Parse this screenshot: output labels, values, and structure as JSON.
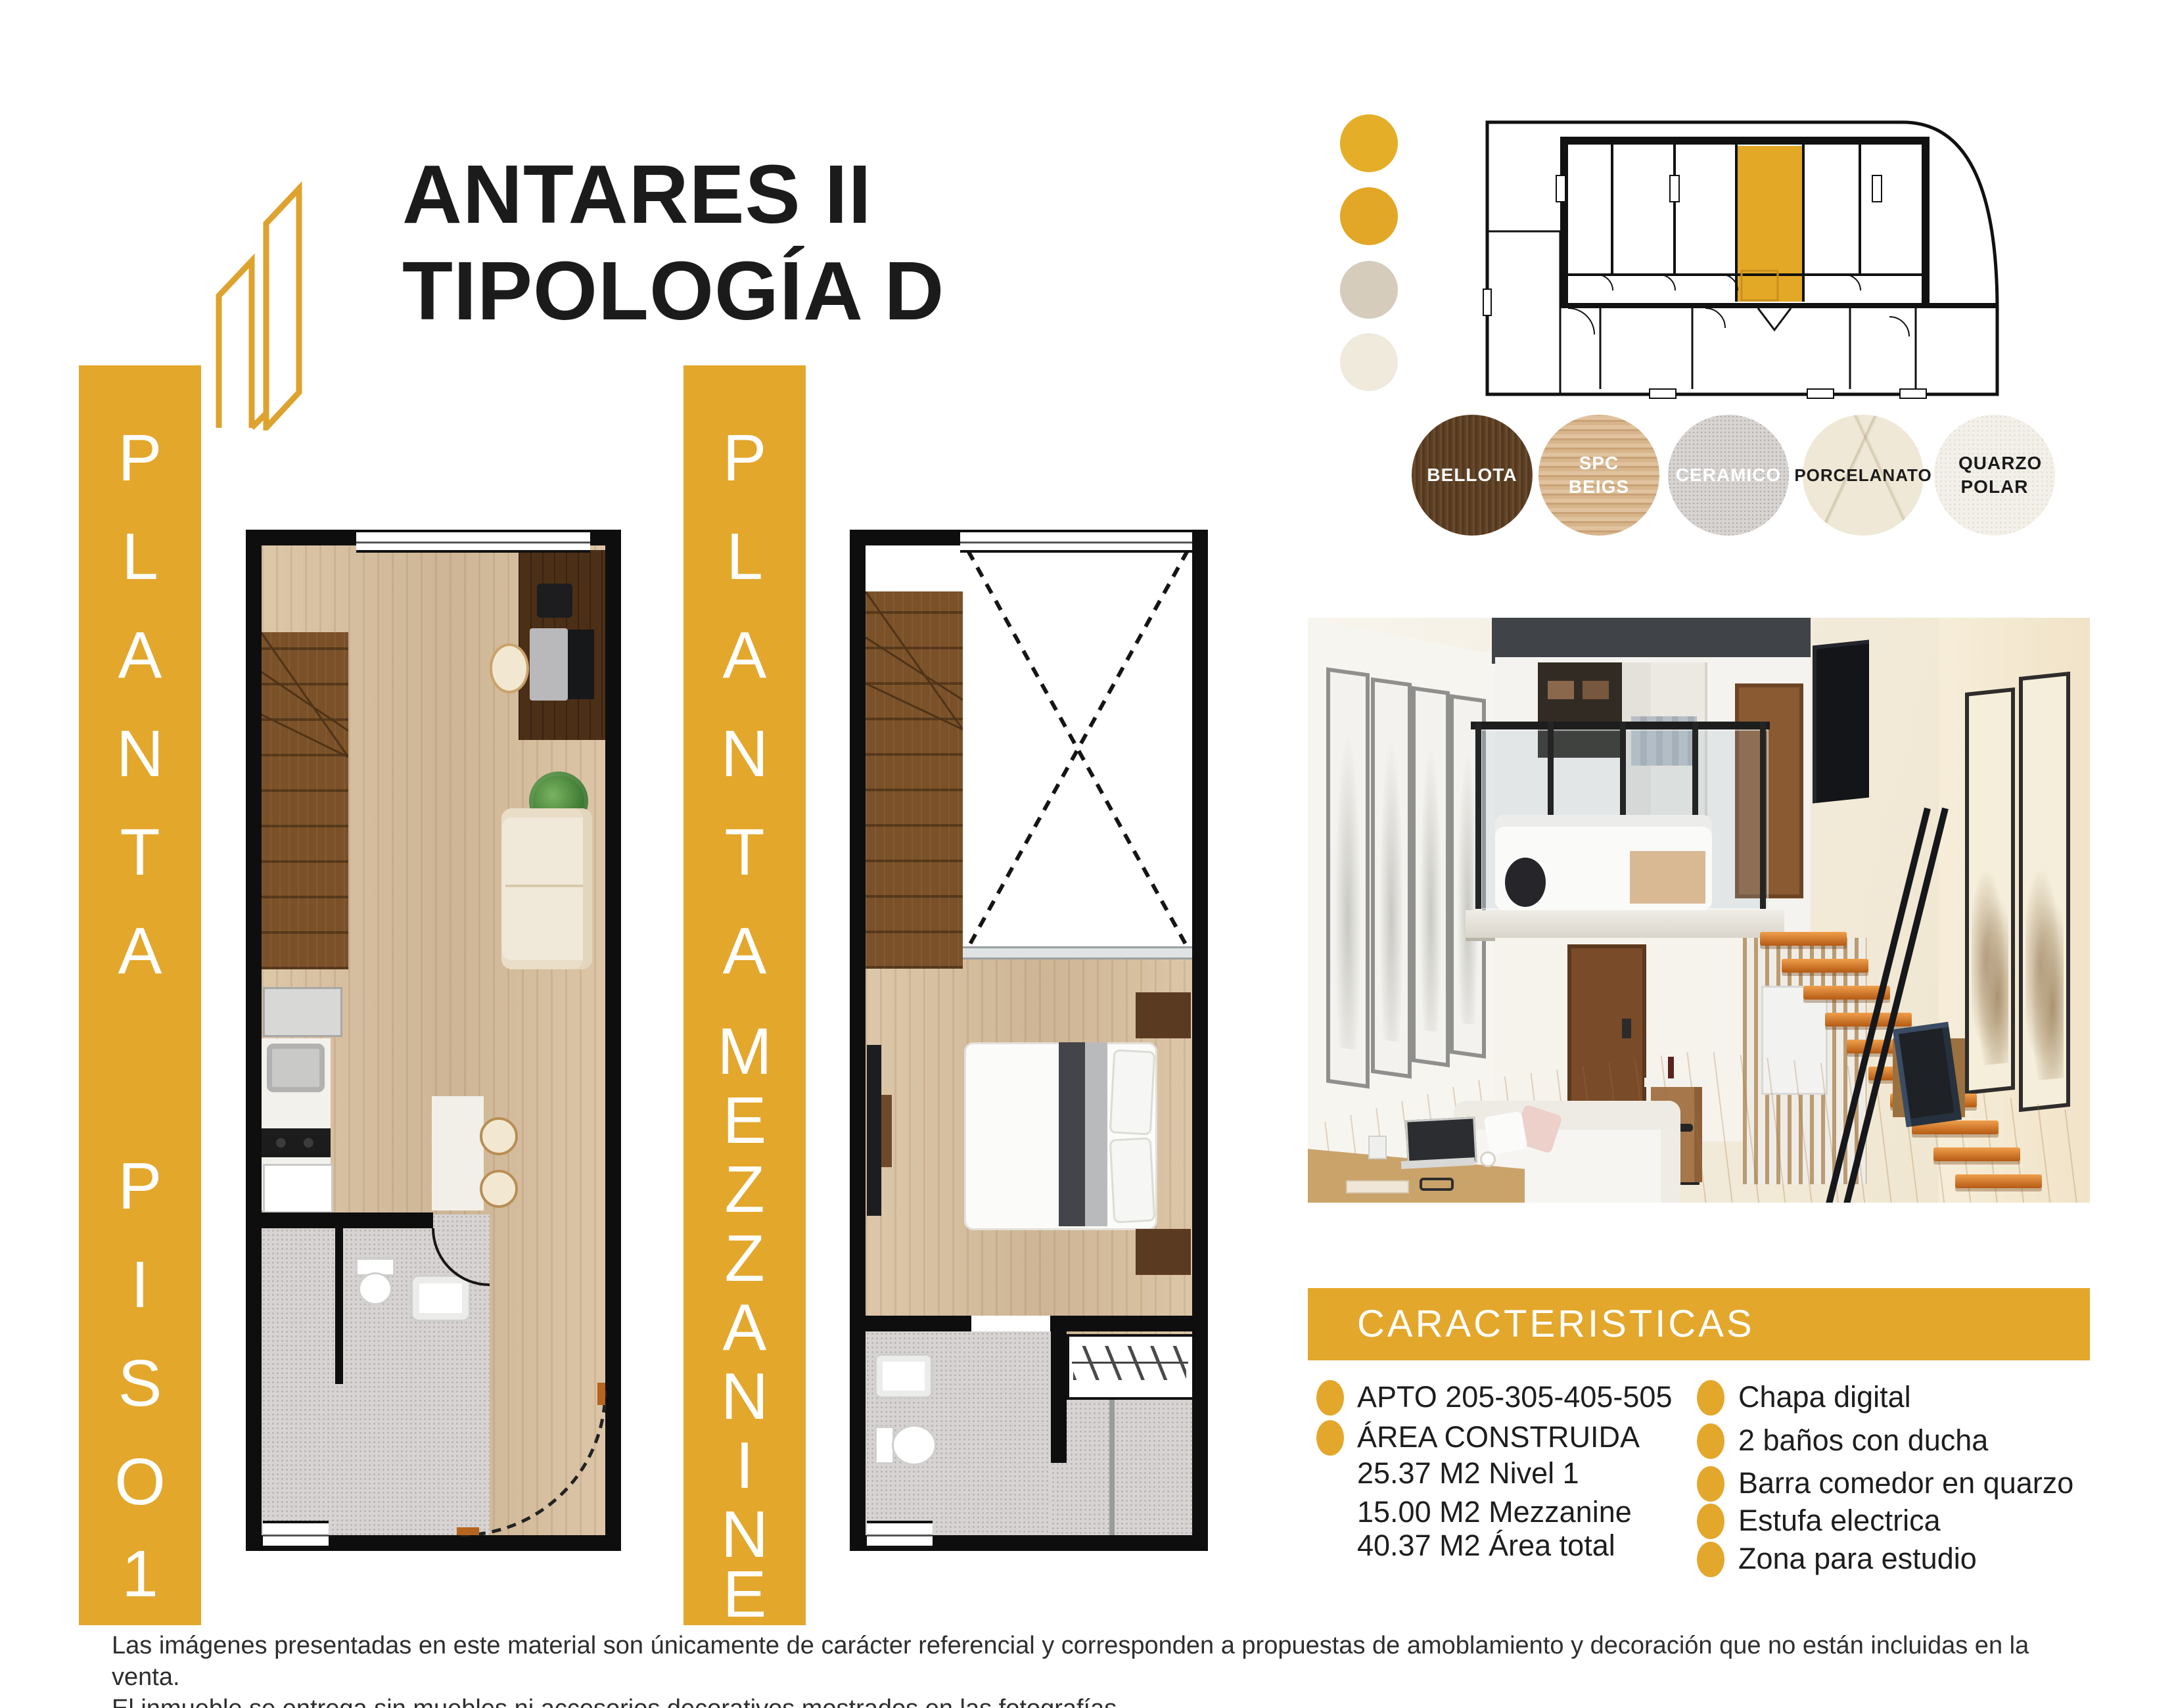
{
  "header": {
    "logo_name": "building-outline-logo",
    "title_line1": "ANTARES II",
    "title_line2": "TIPOLOGÍA D"
  },
  "colors": {
    "gold": "#E3A72C",
    "taupe": "#D5CCBB",
    "cream": "#EFEADC",
    "wall_black": "#0E0E0E",
    "key_plan_highlight": "#E3A926"
  },
  "plan_piso1": {
    "label_vertical": "PLANTA PISO 1",
    "letters": [
      "P",
      "L",
      "A",
      "N",
      "T",
      "A",
      "P",
      "I",
      "S",
      "O",
      "1"
    ]
  },
  "plan_mezzanine": {
    "label_vertical": "PLANTA MEZZANINE",
    "letters": [
      "P",
      "L",
      "A",
      "N",
      "T",
      "A",
      "M",
      "E",
      "Z",
      "Z",
      "A",
      "N",
      "I",
      "N",
      "E"
    ]
  },
  "palette_dots": [
    {
      "name": "gold-light",
      "color": "#E5AE28"
    },
    {
      "name": "gold",
      "color": "#E2A726"
    },
    {
      "name": "taupe",
      "color": "#D5CCBB"
    },
    {
      "name": "cream",
      "color": "#EFEADC"
    }
  ],
  "material_swatches": [
    {
      "label": "BELLOTA",
      "text_color": "#ffffff"
    },
    {
      "label": "SPC BEIGS",
      "text_color": "#ffffff"
    },
    {
      "label": "CERAMICO",
      "text_color": "#ffffff"
    },
    {
      "label": "PORCELANATO",
      "text_color": "#1b1b1b"
    },
    {
      "label": "QUARZO POLAR",
      "text_color": "#1b1b1b"
    }
  ],
  "characteristics": {
    "header": "CARACTERISTICAS",
    "left_items": [
      {
        "text": "APTO 205-305-405-505",
        "bullet": true
      },
      {
        "text": "ÁREA CONSTRUIDA",
        "bullet": true
      },
      {
        "text": "25.37 M2 Nivel 1",
        "bullet": false
      },
      {
        "text": "15.00 M2 Mezzanine",
        "bullet": false
      },
      {
        "text": "40.37 M2 Área total",
        "bullet": false
      }
    ],
    "right_items": [
      "Chapa digital",
      "2 baños con ducha",
      "Barra comedor en quarzo",
      "Estufa electrica",
      "Zona para estudio"
    ]
  },
  "disclaimer": {
    "line1": "Las imágenes presentadas en este material son únicamente de carácter referencial y corresponden a propuestas de amoblamiento y decoración que no están incluidas en la venta.",
    "line2": "El inmueble se entrega sin muebles ni accesorios decorativos mostrados en las fotografías."
  }
}
